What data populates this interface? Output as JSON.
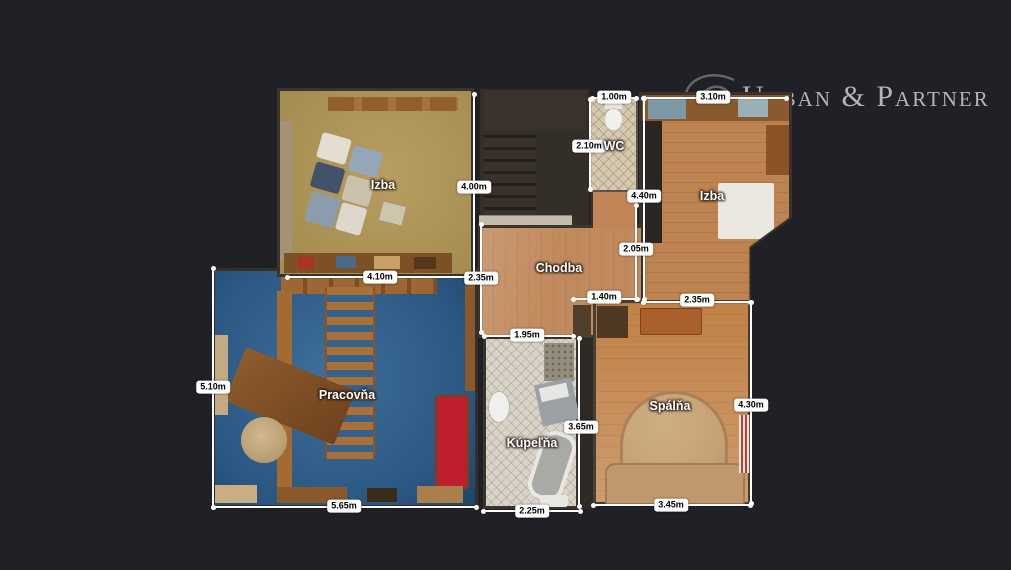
{
  "brand": {
    "logo_text": "Urban & Partner"
  },
  "rooms": {
    "izba_tl": {
      "name": "Izba"
    },
    "wc": {
      "name": "WC"
    },
    "izba_tr": {
      "name": "Izba"
    },
    "chodba": {
      "name": "Chodba"
    },
    "pracovna": {
      "name": "Pracovňa"
    },
    "kupelna": {
      "name": "Kúpeľňa"
    },
    "spalna": {
      "name": "Spálňa"
    }
  },
  "dims": {
    "izba_tl_height": "4.00m",
    "izba_tl_width": "4.10m",
    "chodba_left_height": "2.35m",
    "wc_width": "1.00m",
    "wc_height": "2.10m",
    "izba_tr_width": "3.10m",
    "izba_tr_height": "4.40m",
    "chodba_right_height": "2.05m",
    "chodba_doorway_width": "1.40m",
    "spalna_width_top": "2.35m",
    "spalna_height": "4.30m",
    "spalna_width_bottom": "3.45m",
    "kupelna_width_top": "1.95m",
    "kupelna_height": "3.65m",
    "kupelna_width_bottom": "2.25m",
    "pracovna_height": "5.10m",
    "pracovna_width": "5.65m"
  },
  "colors": {
    "background": "#202126",
    "brand_text": "#b2b4b6",
    "dim_label_bg": "#ffffff",
    "dim_label_text": "#000000",
    "floor_izba_tl": "#ae9455",
    "floor_izba_tr": "#bd8350",
    "floor_chodba": "#c18a5e",
    "floor_spalna": "#c99b70",
    "floor_pracovna": "#3a6890",
    "floor_kupelna": "#d9d3c8",
    "floor_wc": "#d5c9b1"
  }
}
